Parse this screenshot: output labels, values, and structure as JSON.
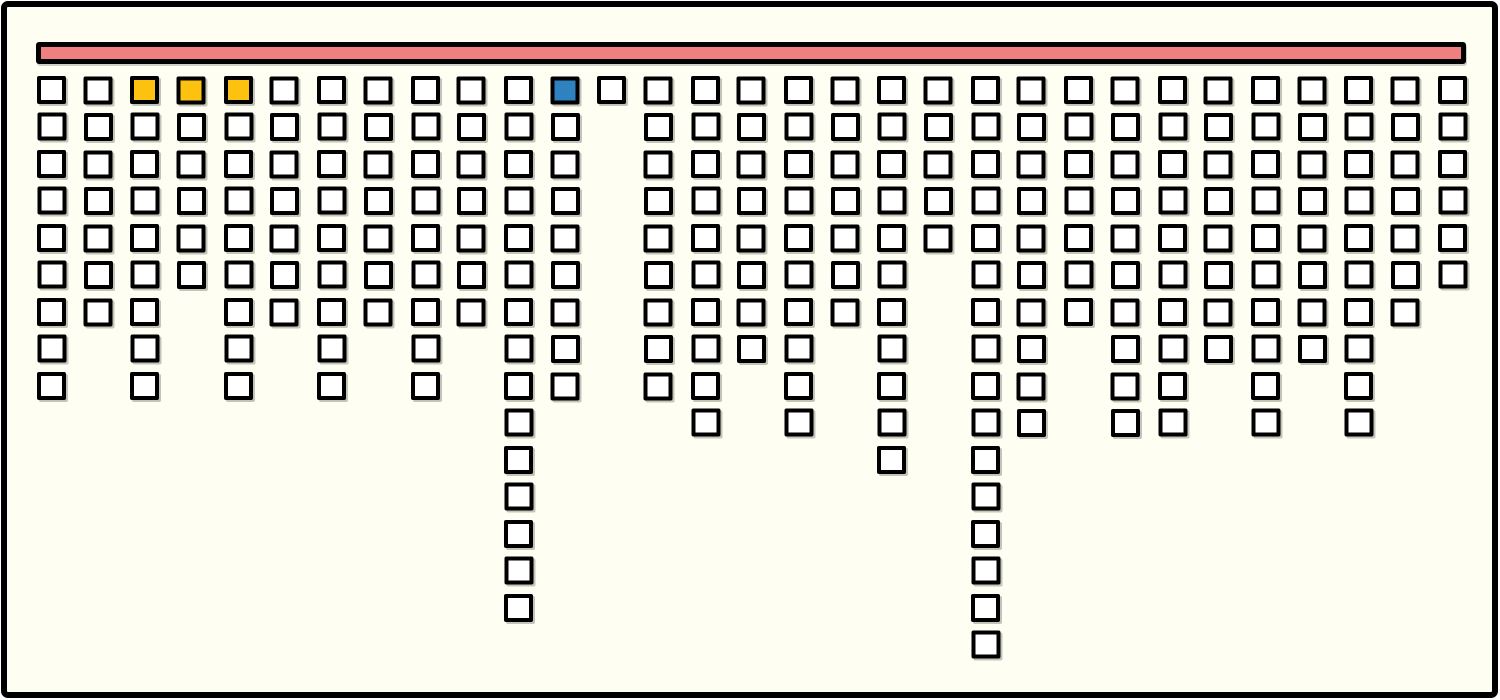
{
  "canvas": {
    "width": 1500,
    "height": 700,
    "background_color": "#fffef2",
    "frame_color": "#000000"
  },
  "chart_data": {
    "type": "waffle-columns",
    "title": "",
    "description": "Hand-drawn style chart: a long horizontal bar at the top with 31 columns of outlined square cells hanging below it, column lengths varying; three gold cells and one blue cell highlighted in the first row.",
    "num_columns": 31,
    "max_column_height": 16,
    "total_cells": 266,
    "categories": [
      "1",
      "2",
      "3",
      "4",
      "5",
      "6",
      "7",
      "8",
      "9",
      "10",
      "11",
      "12",
      "13",
      "14",
      "15",
      "16",
      "17",
      "18",
      "19",
      "20",
      "21",
      "22",
      "23",
      "24",
      "25",
      "26",
      "27",
      "28",
      "29",
      "30",
      "31"
    ],
    "column_heights": [
      9,
      7,
      9,
      6,
      9,
      7,
      9,
      7,
      9,
      7,
      15,
      9,
      1,
      9,
      10,
      8,
      10,
      7,
      11,
      5,
      16,
      10,
      7,
      10,
      10,
      8,
      10,
      8,
      10,
      7,
      6
    ],
    "highlighted_cells": [
      {
        "column": 3,
        "row": 1,
        "color": "#fdc20f",
        "label": "gold"
      },
      {
        "column": 4,
        "row": 1,
        "color": "#fdc20f",
        "label": "gold"
      },
      {
        "column": 5,
        "row": 1,
        "color": "#fdc20f",
        "label": "gold"
      },
      {
        "column": 12,
        "row": 1,
        "color": "#2e82c0",
        "label": "blue"
      }
    ],
    "colors": {
      "cell_fill": "#ffffff",
      "cell_border": "#000000",
      "top_bar_fill": "#f08080",
      "top_bar_border": "#000000",
      "gold_highlight": "#fdc20f",
      "blue_highlight": "#2e82c0"
    },
    "layout_hints": {
      "grid": "off",
      "axes": "none",
      "legend": "none",
      "column_pitch_px": 46.7,
      "row_pitch_px": 37,
      "cell_size_px": [
        29,
        28
      ]
    }
  }
}
